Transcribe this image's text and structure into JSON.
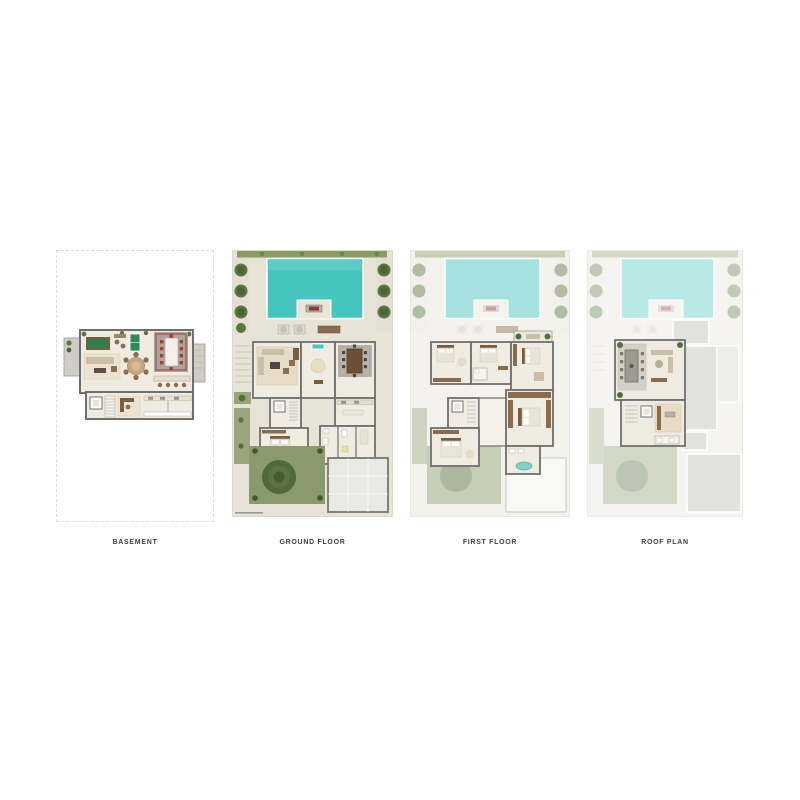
{
  "panels": [
    {
      "id": "basement",
      "label": "BASEMENT"
    },
    {
      "id": "ground-floor",
      "label": "GROUND FLOOR"
    },
    {
      "id": "first-floor",
      "label": "FIRST FLOOR"
    },
    {
      "id": "roof-plan",
      "label": "ROOF PLAN"
    }
  ],
  "colors": {
    "page_background": "#ffffff",
    "pool_water": "#46c5bf",
    "paving": "#e7e3d7",
    "interior_floor": "#f0ebe1",
    "wall": "#6f6f6f",
    "hedge_green": "#8a9b66",
    "lawn_green": "#8b9a6c",
    "tree_green": "#55703f",
    "wood_furniture": "#7d5b3e",
    "billiard_green": "#2f7e50",
    "accent_red": "#8e3b32",
    "majlis_chair_red": "#a33f35",
    "roof_slab_grey": "#e2e2df",
    "basement_outline_dash": "#dcdcdc",
    "label_text": "#3f3f3f"
  }
}
